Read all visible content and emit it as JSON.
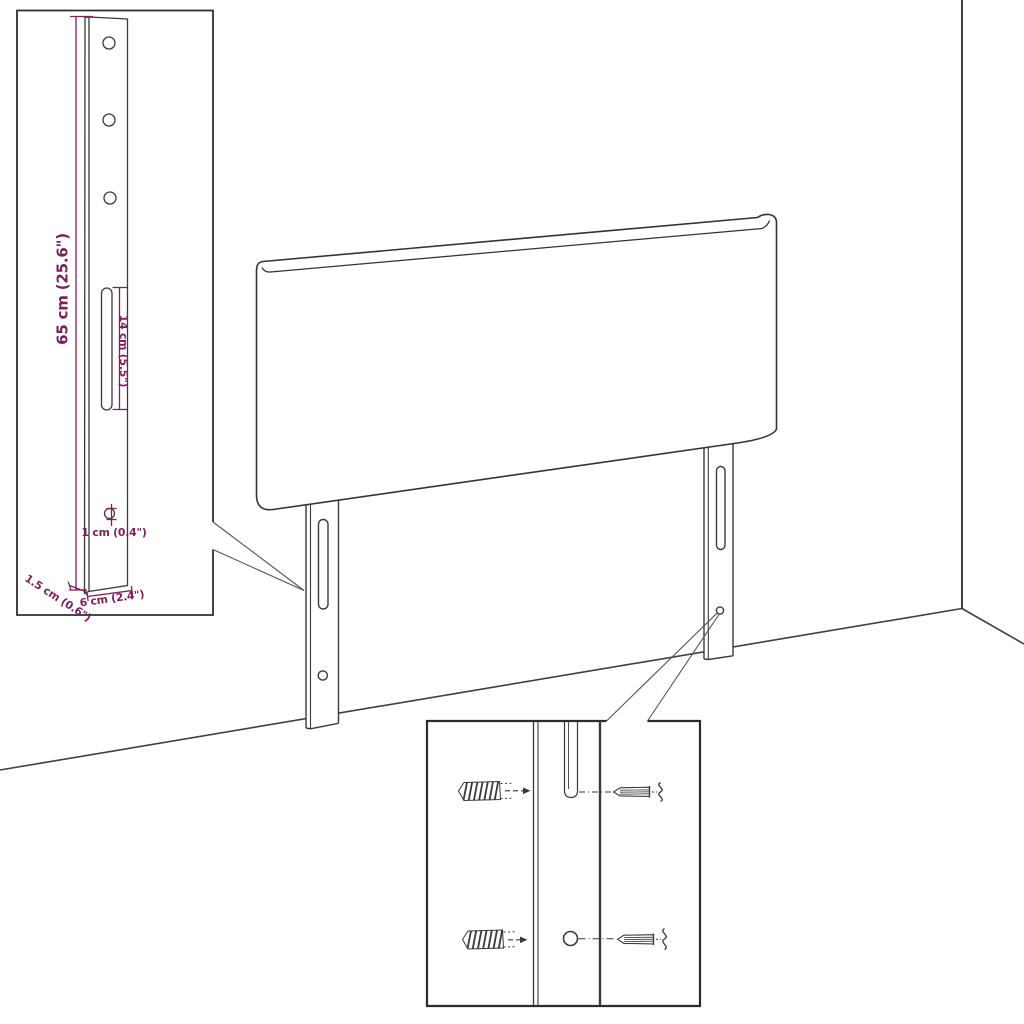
{
  "diagram": {
    "title_hint": "headboard mounting bracket dimension diagram",
    "annotations": {
      "bracket_height": "65 cm (25.6\")",
      "slot_length": "14 cm (5.5\")",
      "hole_diameter": "1 cm (0.4\")",
      "bracket_thickness": "1.5 cm (0.6\")",
      "bracket_width": "6 cm (2.4\")"
    },
    "colors": {
      "dimension_accent": "#7b2160",
      "line": "#3a3a3a",
      "background": "#ffffff"
    }
  }
}
